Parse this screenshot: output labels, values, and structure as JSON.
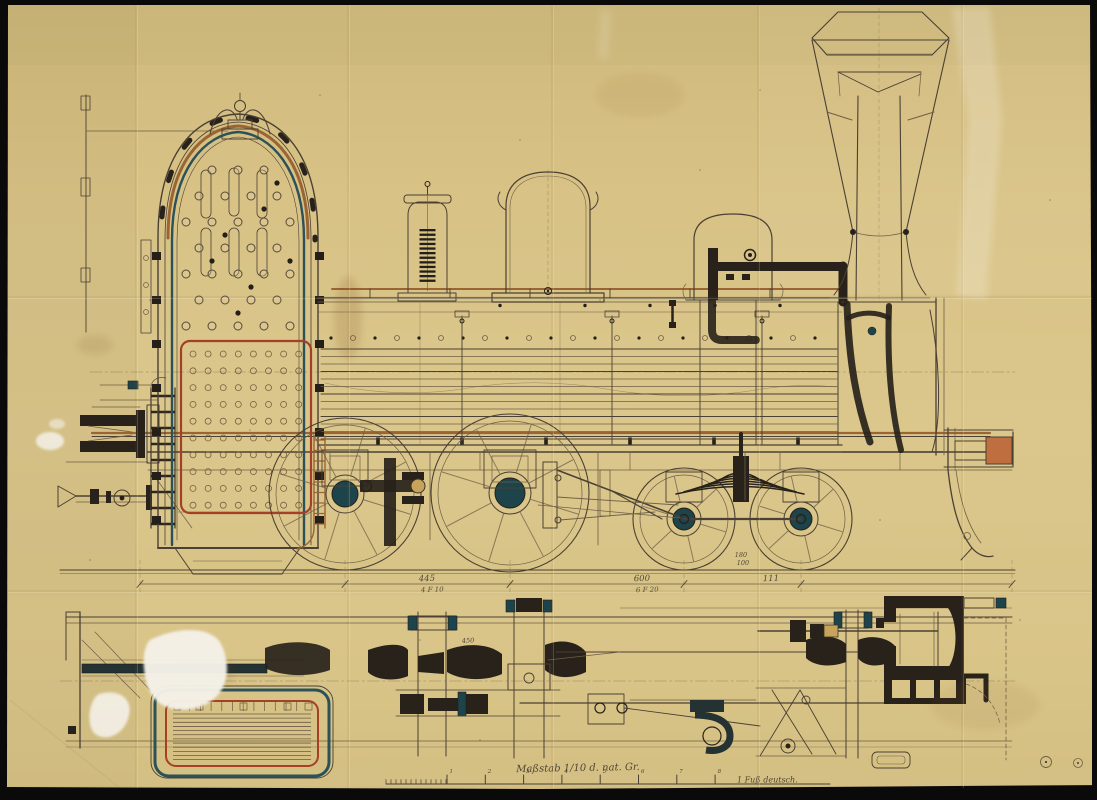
{
  "document": {
    "scale_caption": "Maßstab 1/10 d. nat. Gr.",
    "scale_unit_label": "1 Fuß deutsch.",
    "scale_tick_numerals": [
      "1",
      "2",
      "3",
      "4",
      "5",
      "6",
      "7",
      "8"
    ],
    "dimensions": [
      {
        "value": "445",
        "sub": "4 F 10"
      },
      {
        "value": "600",
        "sub": "6 F 20"
      },
      {
        "value": "111",
        "sub": ""
      },
      {
        "value": "180",
        "sub": "100"
      }
    ],
    "plan_dimensions": [
      {
        "value": "450"
      }
    ],
    "colors": {
      "paper": "#d9c488",
      "ink": "#4a4033",
      "ink_heavy": "#28221a",
      "teal": "#2a5258",
      "teal_fill": "#1e444b",
      "copper": "#9a6433",
      "firebox_red": "#a53f26",
      "buffer_orange": "#bf6f3f",
      "photo_border": "#0a0a0a"
    }
  }
}
